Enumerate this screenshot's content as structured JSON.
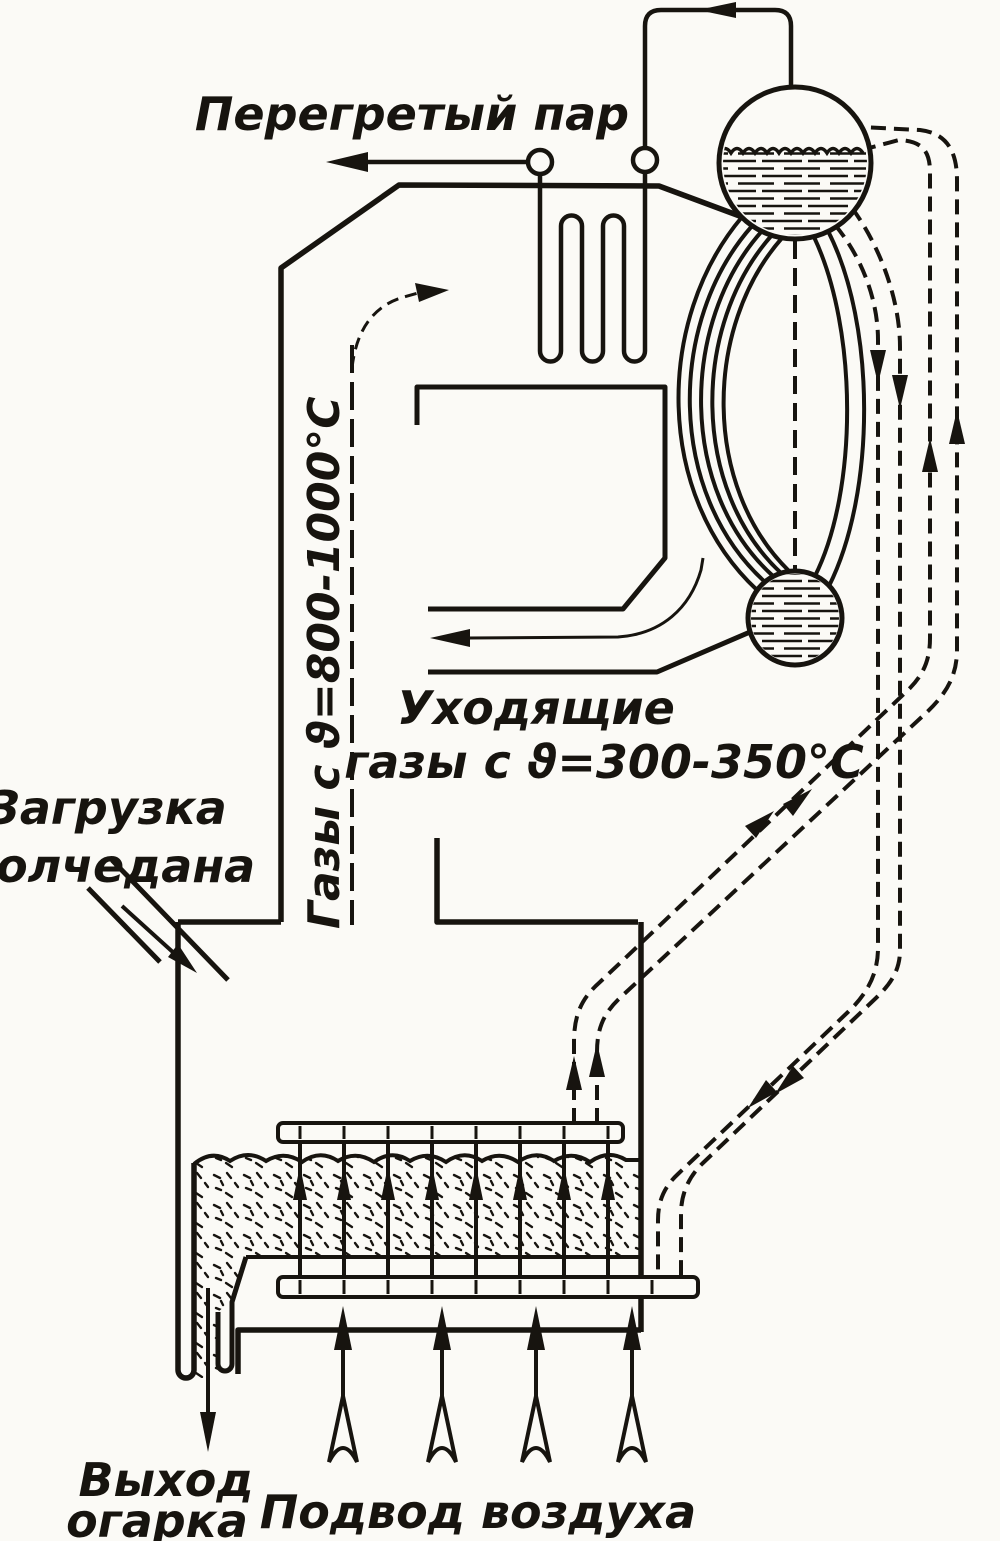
{
  "diagram": {
    "title_hint": "Pyrite roasting fluidized-bed furnace with waste-heat boiler",
    "labels": {
      "superheated_steam": "Перегретый пар",
      "hot_gases": "Газы с ϑ=800-1000°С",
      "exhaust_gases_line1": "Уходящие",
      "exhaust_gases_line2": "газы с ϑ=300-350°С",
      "pyrite_feed_line1": "Загрузка",
      "pyrite_feed_line2": "колчедана",
      "cinder_out_line1": "Выход",
      "cinder_out_line2": "огарка",
      "air_supply": "Подвод воздуха"
    },
    "temperatures": {
      "furnace_gases": "800-1000°С",
      "exhaust_gases": "300-350°С"
    },
    "colors": {
      "ink": "#17140f",
      "paper": "#fbfaf6"
    }
  }
}
